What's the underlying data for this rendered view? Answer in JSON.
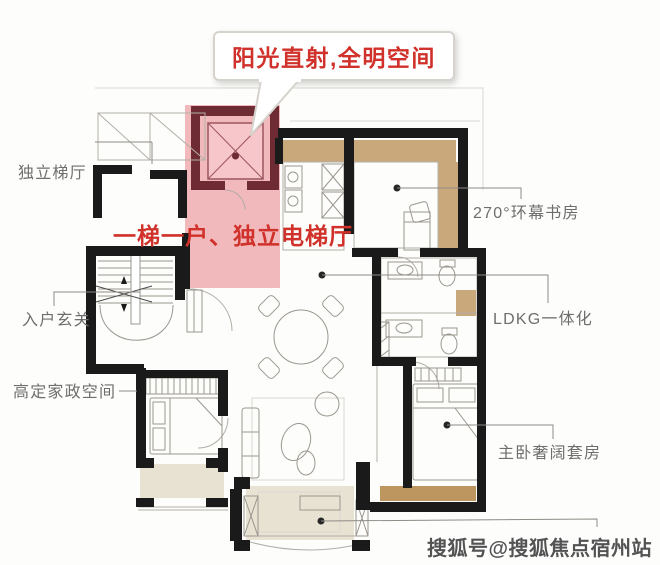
{
  "callout": {
    "text": "阳光直射,全明空间"
  },
  "annotations": {
    "elevator_note": {
      "text": "一梯一户、独立电梯厅"
    }
  },
  "labels": {
    "elevator_hall": {
      "text": "独立梯厅"
    },
    "entry_foyer": {
      "text": "入户玄关"
    },
    "housekeeping": {
      "text": "高定家政空间"
    },
    "study": {
      "text": "270°环幕书房"
    },
    "ldkg": {
      "text": "LDKG一体化"
    },
    "master_suite": {
      "text": "主卧奢阔套房"
    }
  },
  "watermark": {
    "text": "搜狐号@搜狐焦点宿州站"
  },
  "colors": {
    "accent_red": "#d0312a",
    "highlight_pink": "#f2b9bd",
    "highlight_wall": "#6f2b33",
    "wood_tan": "#c9a87c",
    "wood_dark": "#bd965f",
    "balcony_beige": "#e8e2d3",
    "wall_black": "#1a1a1a",
    "label_gray": "#6e6e6e"
  }
}
